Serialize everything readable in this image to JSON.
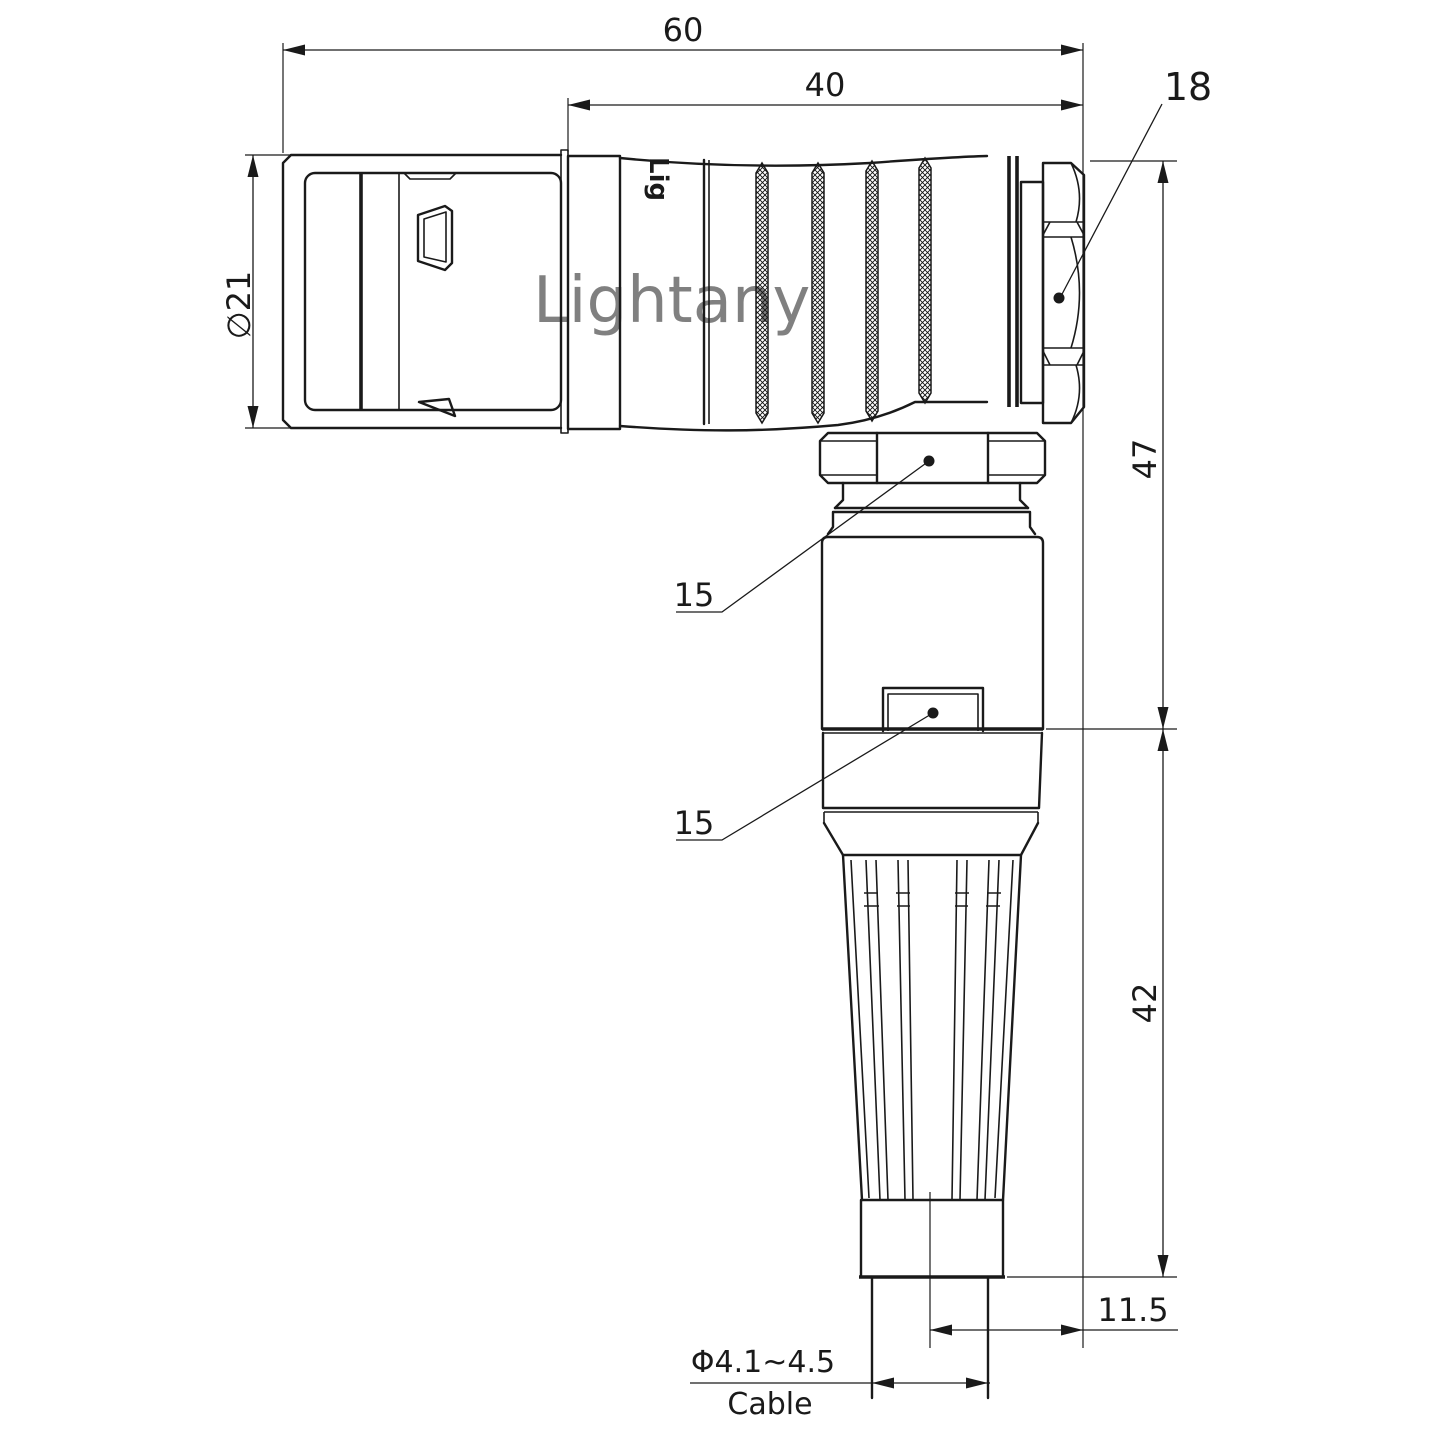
{
  "watermark": {
    "text": "Lightany",
    "color": "#edb5b5"
  },
  "part_marking": {
    "text": "Lig"
  },
  "dimensions": {
    "overall_length": {
      "value": "60"
    },
    "rear_length": {
      "value": "40"
    },
    "coupling_nut": {
      "value": "18"
    },
    "front_diameter": {
      "value": "∅21"
    },
    "elbow_height": {
      "value": "47"
    },
    "strain_relief_height": {
      "value": "42"
    },
    "backnut_flats": {
      "value": "15"
    },
    "body_flats": {
      "value": "15"
    },
    "cable_offset": {
      "value": "11.5"
    },
    "cable_diameter": {
      "value": "Φ4.1~4.5"
    },
    "cable_label": {
      "value": "Cable"
    }
  },
  "colors": {
    "line": "#1a1a1a",
    "background": "#ffffff"
  }
}
